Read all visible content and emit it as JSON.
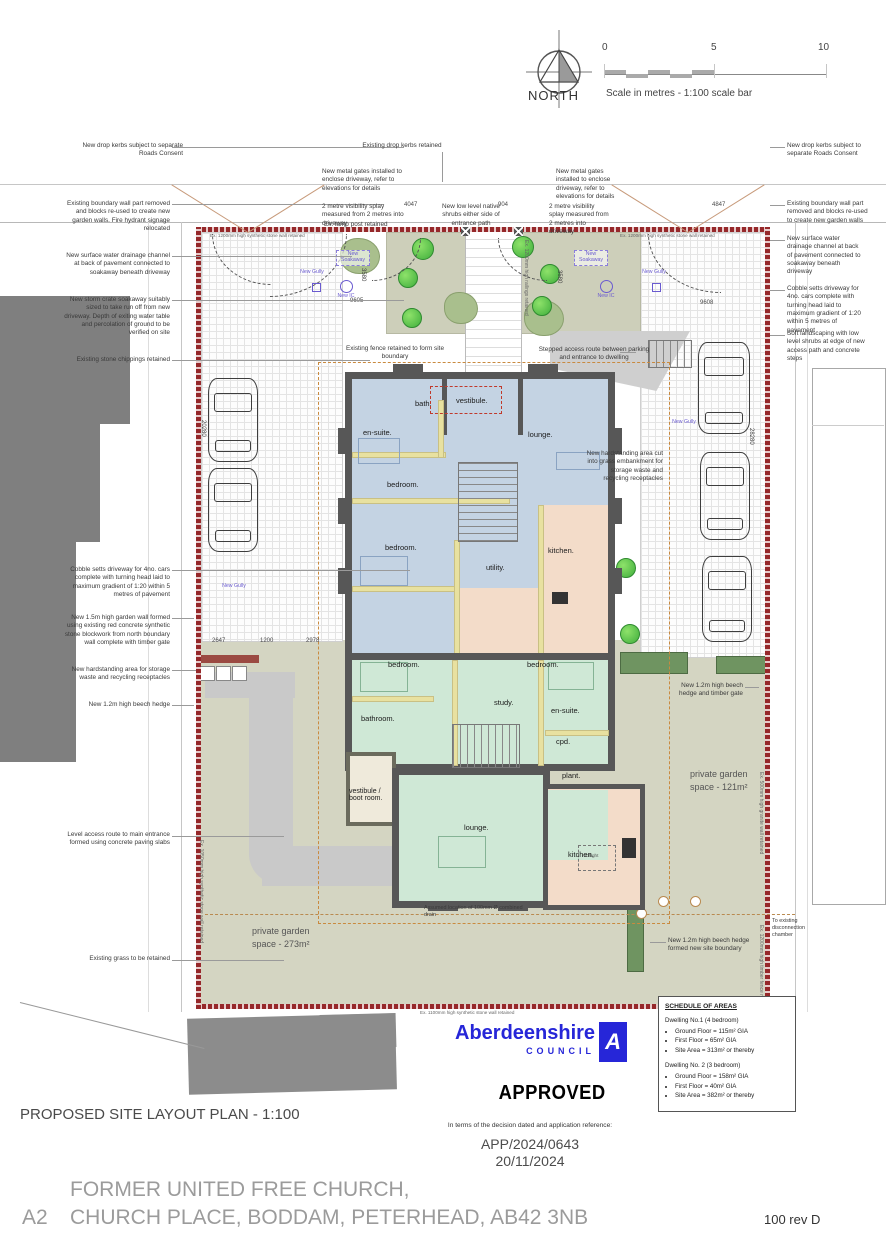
{
  "header": {
    "north": "NORTH",
    "scale_caption": "Scale in metres - 1:100 scale bar",
    "scale_ticks": [
      "0",
      "5",
      "10"
    ]
  },
  "ann_left": [
    "New drop kerbs subject to separate Roads Consent",
    "Existing boundary wall part removed and blocks re-used to create new garden walls. Fire hydrant signage relocated",
    "New surface water drainage channel at back of pavement connected to soakaway beneath driveway",
    "New storm crate soakaway suitably sized to take run off from new driveway. Depth of exiting water table and percolation of ground to be verified on site",
    "Existing stone chippings retained",
    "Cobble setts driveway for 4no. cars complete with turning head laid to maximum gradient of 1:20 within 5 metres of pavement",
    "New 1.5m high garden wall formed using existing red concrete synthetic stone blockwork from north boundary wall complete with timber gate",
    "New hardstanding area for storage waste and recycling receptacles",
    "New 1.2m high beech hedge",
    "Level access route to main entrance formed using concrete paving slabs",
    "Existing grass to be retained"
  ],
  "ann_top": [
    "Existing drop kerbs retained",
    "New metal gates installed to enclose driveway, refer to elevations for details",
    "2 metre visibility splay measured from 2 metres into driveway",
    "Ex. lamp post retained",
    "New low level native shrubs either side of entrance path",
    "New metal gates installed to enclose driveway, refer to elevations for details",
    "2 metre visibility splay measured from 2 metres into driveway"
  ],
  "ann_right": [
    "New drop kerbs subject to separate Roads Consent",
    "Existing boundary wall part removed and blocks re-used to create new garden walls",
    "New surface water drainage channel at back of pavement connected to soakaway beneath driveway",
    "Cobble setts driveway for 4no. cars complete with turning head laid to maximum gradient of 1:20 within 5 metres of pavement",
    "Soft landscaping with low level shrubs at edge of new access path and concrete steps"
  ],
  "ann_inner": [
    "Existing fence retained to form site boundary",
    "Stepped access route between parking and entrance to dwelling",
    "New hardstanding area cut into grass embankment for storage waste and recycling receptacles",
    "New 1.2m high beech hedge and timber gate",
    "New 1.2m high beech hedge formed new site boundary",
    "To existing disconnection chamber",
    "Assumed location of 100mm Ø combined drain"
  ],
  "garden": {
    "right_l1": "private garden",
    "right_l2": "space - 121m²",
    "left_l1": "private garden",
    "left_l2": "space - 273m²"
  },
  "rooms_upper": [
    "bath.",
    "vestibule.",
    "en-suite.",
    "lounge.",
    "bedroom.",
    "bedroom.",
    "utility.",
    "kitchen."
  ],
  "rooms_lower": [
    "bedroom.",
    "bedroom.",
    "study.",
    "en-suite.",
    "bathroom.",
    "cpd.",
    "plant.",
    "vestibule / boot room.",
    "lounge.",
    "kitchen."
  ],
  "misc": {
    "rooflight": "rooflight"
  },
  "dims": {
    "d4047": "4047",
    "d904": "904",
    "d4847": "4847",
    "d9605": "9605",
    "d9608": "9608",
    "d2647": "2647",
    "d1200": "1200",
    "d2978": "2978",
    "d3580a": "3580",
    "d3580b": "3580",
    "d20280": "20280",
    "d28280": "28280"
  },
  "drainage": {
    "soakaway": "New Soakaway",
    "gully": "New Gully",
    "ic": "New IC"
  },
  "boundary_labels": {
    "stone_wall": "Ex. 1200mm high synthetic stone wall retained",
    "railings": "Ex. 1200mm high railings retained",
    "granite": "Ex. 500mm high granite wall retained",
    "timber": "Ex. 1200mm high timber fence retained",
    "stone_1050": "Ex. 1050mm high synthetic stone wall retained",
    "stone_1100": "Ex. 1100mm high synthetic stone wall retained"
  },
  "stamp": {
    "council_name": "Aberdeenshire",
    "council_word": "COUNCIL",
    "logo_letter": "A",
    "approved": "APPROVED",
    "terms": "In terms of the decision dated and application reference:",
    "app_ref": "APP/2024/0643",
    "date": "20/11/2024"
  },
  "schedule": {
    "title": "SCHEDULE OF AREAS",
    "d1_head": "Dwelling No.1  (4 bedroom)",
    "d1_items": [
      "Ground Floor = 115m² GIA",
      "First Floor = 65m² GIA",
      "Site Area = 313m² or thereby"
    ],
    "d2_head": "Dwelling No. 2  (3 bedroom)",
    "d2_items": [
      "Ground Floor = 158m² GIA",
      "First Floor = 40m² GIA",
      "Site Area = 382m² or thereby"
    ]
  },
  "titles": {
    "plan_title": "PROPOSED SITE LAYOUT PLAN - 1:100",
    "sheet": "A2",
    "line1": "FORMER UNITED FREE CHURCH,",
    "line2": "CHURCH PLACE, BODDAM, PETERHEAD, AB42 3NB",
    "drawing_no": "100 rev D"
  }
}
